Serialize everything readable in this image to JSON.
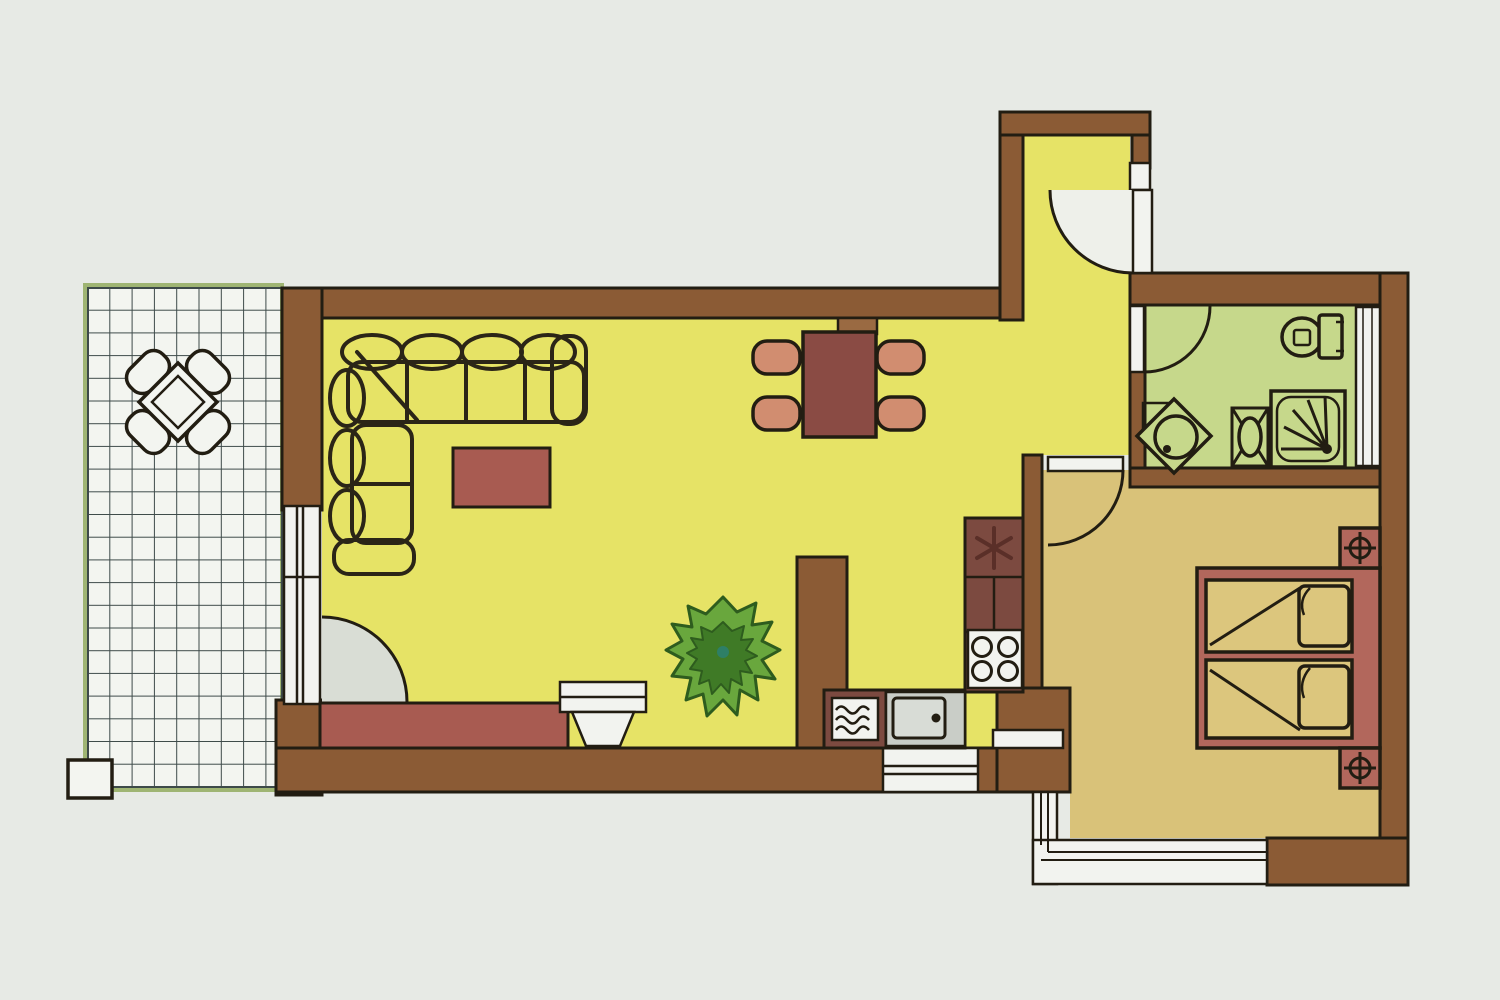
{
  "title": "Apartment floor plan",
  "colors": {
    "background": "#e7eae5",
    "wall": "#8b5b35",
    "outline": "#221d12",
    "living_floor": "#e6e366",
    "bathroom_floor": "#c6d88b",
    "bedroom_floor": "#d9c279",
    "terrace_floor": "#f3f5f0",
    "terrace_grid": "#3d4a49",
    "furniture": "#a85b51",
    "counter": "#7c4a40",
    "dining_table": "#8a4b44",
    "chair": "#d18d70",
    "bed_frame": "#b2675c",
    "mattress": "#dcc67d",
    "fixture_white": "#f2f3ef",
    "swing_gray": "#d9ddd5",
    "plant": "#69a73d",
    "plant_dark": "#3f7a26",
    "sink_gray": "#c9cdc7"
  },
  "rooms": [
    {
      "name": "terrace",
      "floor": "white-tile-grid",
      "furniture": [
        "patio-table",
        "patio-chair x4",
        "post"
      ]
    },
    {
      "name": "living-dining-room",
      "floor": "yellow",
      "furniture": [
        "corner-sofa",
        "coffee-table",
        "sideboard",
        "tv",
        "plant",
        "dining-table",
        "dining-chair x4"
      ],
      "openings": [
        "balcony-window",
        "balcony-door"
      ]
    },
    {
      "name": "kitchen",
      "floor": "yellow",
      "appliances": [
        "refrigerator-cabinet",
        "stove-4-burners",
        "sink",
        "washing-machine"
      ],
      "openings": [
        "kitchen-window",
        "pass-through"
      ]
    },
    {
      "name": "entry-hallway",
      "floor": "yellow",
      "openings": [
        "entrance-door"
      ]
    },
    {
      "name": "bathroom",
      "floor": "green",
      "fixtures": [
        "toilet",
        "corner-basin",
        "pedestal-washbasin",
        "shower"
      ],
      "openings": [
        "bathroom-door",
        "bathroom-window"
      ]
    },
    {
      "name": "bedroom",
      "floor": "tan",
      "furniture": [
        "double-bed",
        "pillow x2",
        "nightstand-with-lamp x2"
      ],
      "openings": [
        "bedroom-door",
        "bedroom-window"
      ]
    }
  ]
}
